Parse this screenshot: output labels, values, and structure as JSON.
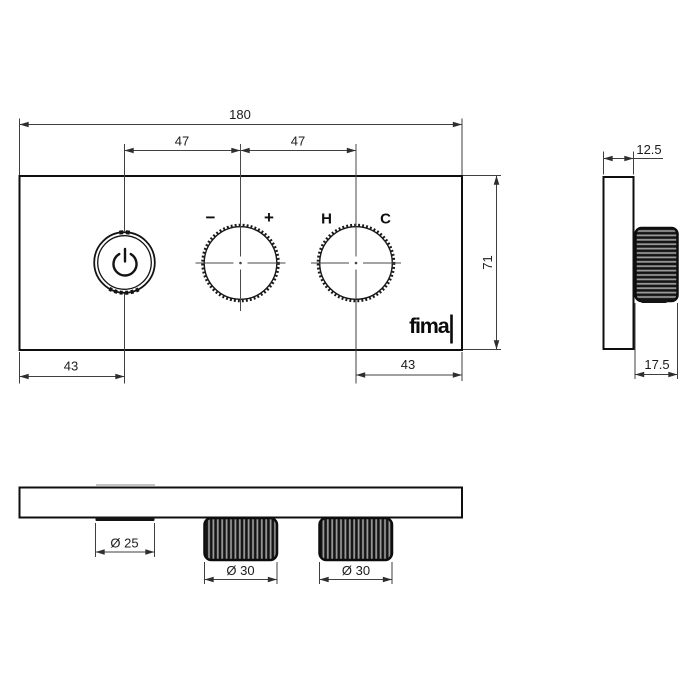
{
  "drawing_title": "thermostatic-mixer-technical-drawing",
  "brand": {
    "logo": "fima"
  },
  "dims": {
    "overall_width": "180",
    "spacing_left": "47",
    "spacing_right": "47",
    "offset_left": "43",
    "offset_right": "43",
    "height": "71",
    "thickness": "12.5",
    "knob_depth": "17.5",
    "button_diameter": "Ø 25",
    "volume_knob_diameter": "Ø 30",
    "temperature_knob_diameter": "Ø 30"
  },
  "labels": {
    "minus": "−",
    "plus": "+",
    "hot": "H",
    "cold": "C"
  },
  "colors": {
    "object_line": "#0f0f0f",
    "dimension_line": "#3f3f3f",
    "knurl_dark": "#141414",
    "knurl_light": "#9a9a9a",
    "background": "#ffffff"
  }
}
